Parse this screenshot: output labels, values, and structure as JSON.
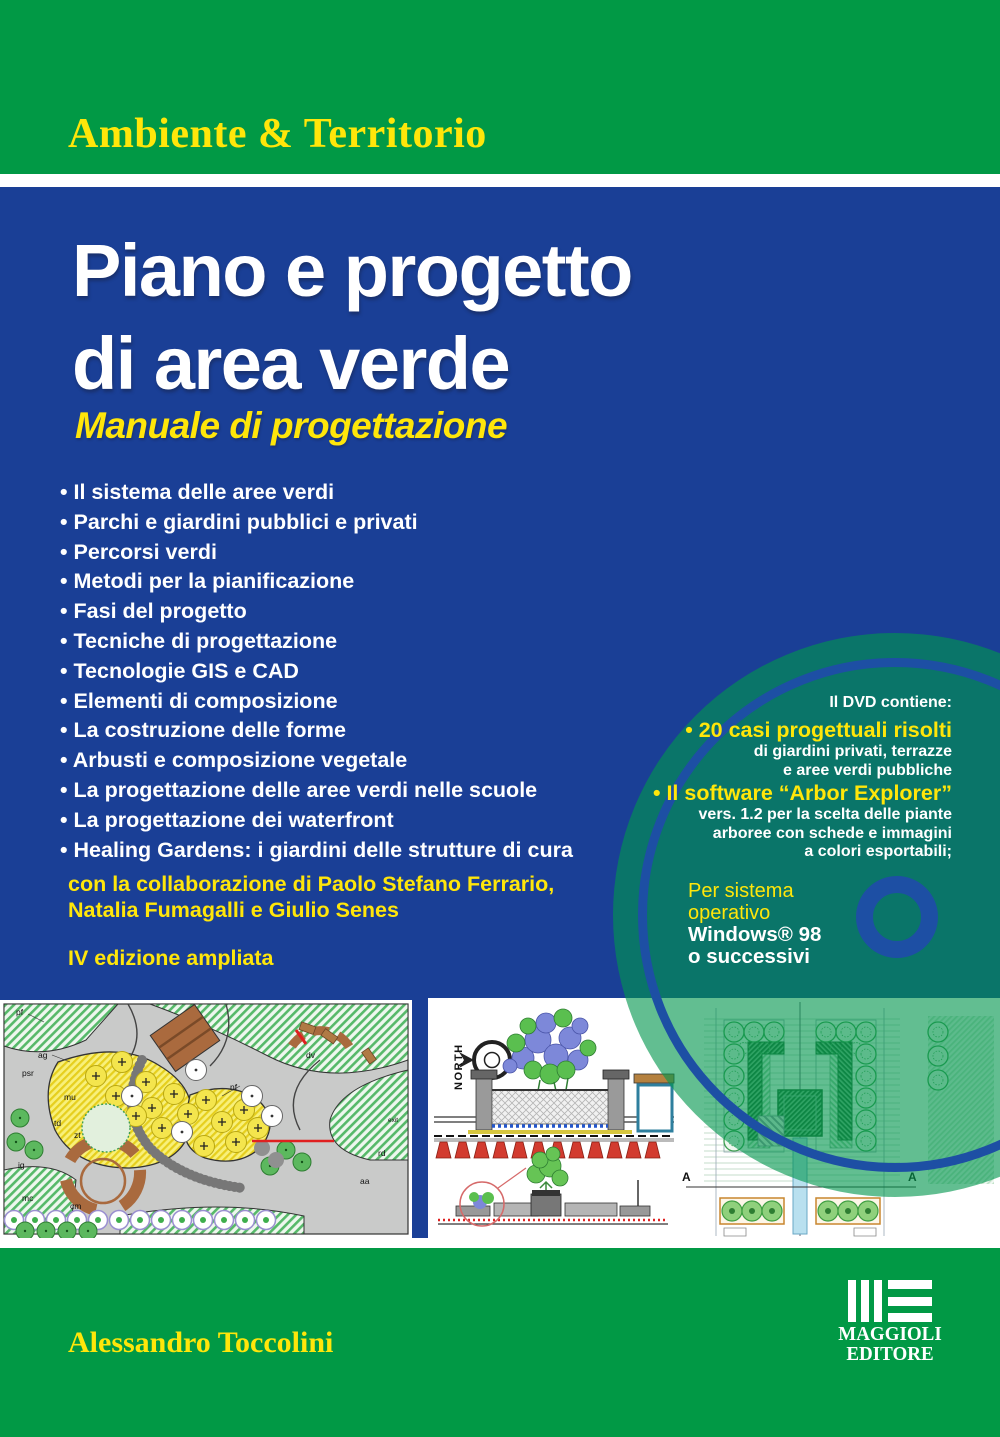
{
  "series": {
    "label": "Ambiente & Territorio"
  },
  "title": {
    "line1": "Piano e progetto",
    "line2": "di area verde"
  },
  "subtitle": "Manuale di progettazione",
  "topics": [
    "Il sistema delle aree verdi",
    "Parchi e giardini pubblici e privati",
    "Percorsi verdi",
    "Metodi per la pianificazione",
    "Fasi del progetto",
    "Tecniche di progettazione",
    "Tecnologie GIS e CAD",
    "Elementi di composizione",
    "La costruzione delle forme",
    "Arbusti e composizione vegetale",
    "La progettazione delle aree verdi nelle scuole",
    "La progettazione dei waterfront",
    "Healing Gardens: i giardini delle strutture di cura"
  ],
  "collaboration": {
    "line1": "con la collaborazione di Paolo Stefano Ferrario,",
    "line2": "Natalia Fumagalli e Giulio Senes"
  },
  "edition": "IV edizione ampliata",
  "dvd": {
    "heading": "Il DVD contiene:",
    "item1": {
      "title": "• 20 casi progettuali risolti",
      "line1": "di giardini privati, terrazze",
      "line2": "e aree verdi pubbliche"
    },
    "item2": {
      "title": "• Il software “Arbor Explorer”",
      "line1": "vers. 1.2 per la scelta delle piante",
      "line2": "arboree con schede e immagini",
      "line3": "a colori esportabili;"
    },
    "os": {
      "line1": "Per sistema",
      "line2": "operativo",
      "line3": "Windows® 98",
      "line4": "o successivi"
    }
  },
  "author": "Alessandro Toccolini",
  "publisher": {
    "line1": "MAGGIOLI",
    "line2": "EDITORE"
  },
  "artwork": {
    "compass_label": "NORTH",
    "section_label": "A — A",
    "section_a_left": "A",
    "section_a_right": "A",
    "plan_labels": [
      "pf",
      "ag",
      "psr",
      "mu",
      "td",
      "zt",
      "ig",
      "mc",
      "cm",
      "nf",
      "dv",
      "rd",
      "aa",
      "exit"
    ]
  },
  "colors": {
    "band_green": "#019945",
    "cover_blue": "#1a3f96",
    "accent_yellow": "#ffe60a",
    "dvd_disc_green": "rgba(1,150,78,0.62)",
    "ring_blue": "#1d4fa4",
    "text_white": "#ffffff"
  }
}
